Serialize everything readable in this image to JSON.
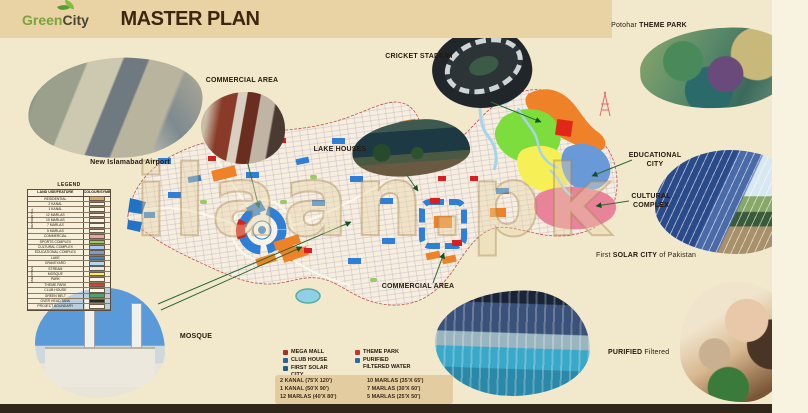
{
  "palette": {
    "background": "#f2e9cd",
    "header_band": "#e9d2a4",
    "title_text": "#3c2612",
    "logo_green": "#7aa43c",
    "callout_line_green": "#2e6b33",
    "commercial_orange": "#ef8228",
    "water_blue": "#2f7fd6",
    "sports_green": "#7ddd3d",
    "education_blue": "#6a99d8",
    "cultural_pink": "#e8839a",
    "mosque_yellow": "#f6ef55",
    "boundary_red": "#c05050",
    "footer_strip": "#30261a"
  },
  "header": {
    "logo_green": "Green",
    "logo_city": "City",
    "title": "MASTER PLAN"
  },
  "watermark": "ilaan.pk",
  "callouts": {
    "airport": {
      "label": "New Islamabad Airport"
    },
    "commercial_top": {
      "label": "COMMERCIAL AREA"
    },
    "lake_houses": {
      "label": "LAKE HOUSES"
    },
    "cricket_stadium": {
      "label": "CRICKET STADIUM"
    },
    "theme_park": {
      "prefix": "Potohar ",
      "label": "THEME PARK"
    },
    "educational_city": {
      "line1": "EDUCATIONAL",
      "line2": "CITY"
    },
    "cultural_complex": {
      "line1": "CULTURAL",
      "line2": "COMPLEX"
    },
    "solar_city": {
      "prefix": "First ",
      "bold": "SOLAR CITY",
      "suffix": " of Pakistan"
    },
    "mosque": {
      "label": "MOSQUE"
    },
    "commercial_bottom": {
      "label": "COMMERCIAL AREA"
    },
    "purified": {
      "bold": "PURIFIED",
      "suffix": " Filtered"
    }
  },
  "legend": {
    "title": "LEGEND",
    "col_feature": "LAND USE/FEATURE",
    "col_symbol": "COLOUR/SYMBOL",
    "group_residential": "RESIDENTIAL",
    "group_amenities": "AMENITIES",
    "rows": [
      {
        "label": "RESIDENTIAL",
        "color": "#d9a869"
      },
      {
        "label": "2 KANAL",
        "color": "#f8f4e6"
      },
      {
        "label": "1 KANAL",
        "color": "#f8f4e6"
      },
      {
        "label": "12 MARLAS",
        "color": "#f8f4e6"
      },
      {
        "label": "10 MARLAS",
        "color": "#f8f4e6"
      },
      {
        "label": "7 MARLAS",
        "color": "#f8f4e6"
      },
      {
        "label": "5 MARLAS",
        "color": "#f8f4e6"
      },
      {
        "label": "COMMERCIAL",
        "color": "#f0a0a8"
      },
      {
        "label": "SPORTS COMPLEX",
        "color": "#90d060"
      },
      {
        "label": "CULTURAL COMPLEX",
        "color": "#a8c8ec"
      },
      {
        "label": "EDUCATIONAL COMPLEX",
        "color": "#70a0dc"
      },
      {
        "label": "LAKE",
        "color": "#3c88d4"
      },
      {
        "label": "GRAVEYARD",
        "color": "#b0d8f0"
      },
      {
        "label": "STREAM",
        "color": "#d8ecf8"
      },
      {
        "label": "MOSQUE",
        "color": "#f8f060"
      },
      {
        "label": "PARK",
        "color": "#f8f4e6"
      },
      {
        "label": "THEME PARK",
        "color": "#d84038"
      },
      {
        "label": "CLUB HOUSE",
        "color": "#f8f4e6"
      },
      {
        "label": "GREEN BELT",
        "color": "#50a070"
      },
      {
        "label": "OVER HEAD TANK",
        "color": "#282828"
      },
      {
        "label": "PROJECT BOUNDARY",
        "color": "#f8f4e6"
      }
    ]
  },
  "amenities": {
    "col1": [
      {
        "label": "MEGA MALL",
        "color": "#a93226"
      },
      {
        "label": "CLUB HOUSE",
        "color": "#2e5fa0"
      },
      {
        "label": "FIRST SOLAR CITY",
        "color": "#1f618d"
      }
    ],
    "col2": [
      {
        "label": "THEME PARK",
        "color": "#c0392b"
      },
      {
        "label": "PURIFIED FILTERED WATER",
        "color": "#2471a3"
      }
    ]
  },
  "plot_sizes": [
    "2 KANAL (75'X 120')",
    "10 MARLAS (35'X 65')",
    "1 KANAL (50'X 90')",
    "7 MARLAS (30'X 60')",
    "12 MARLAS (40'X 80')",
    "5 MARLAS (25'X 50')"
  ]
}
